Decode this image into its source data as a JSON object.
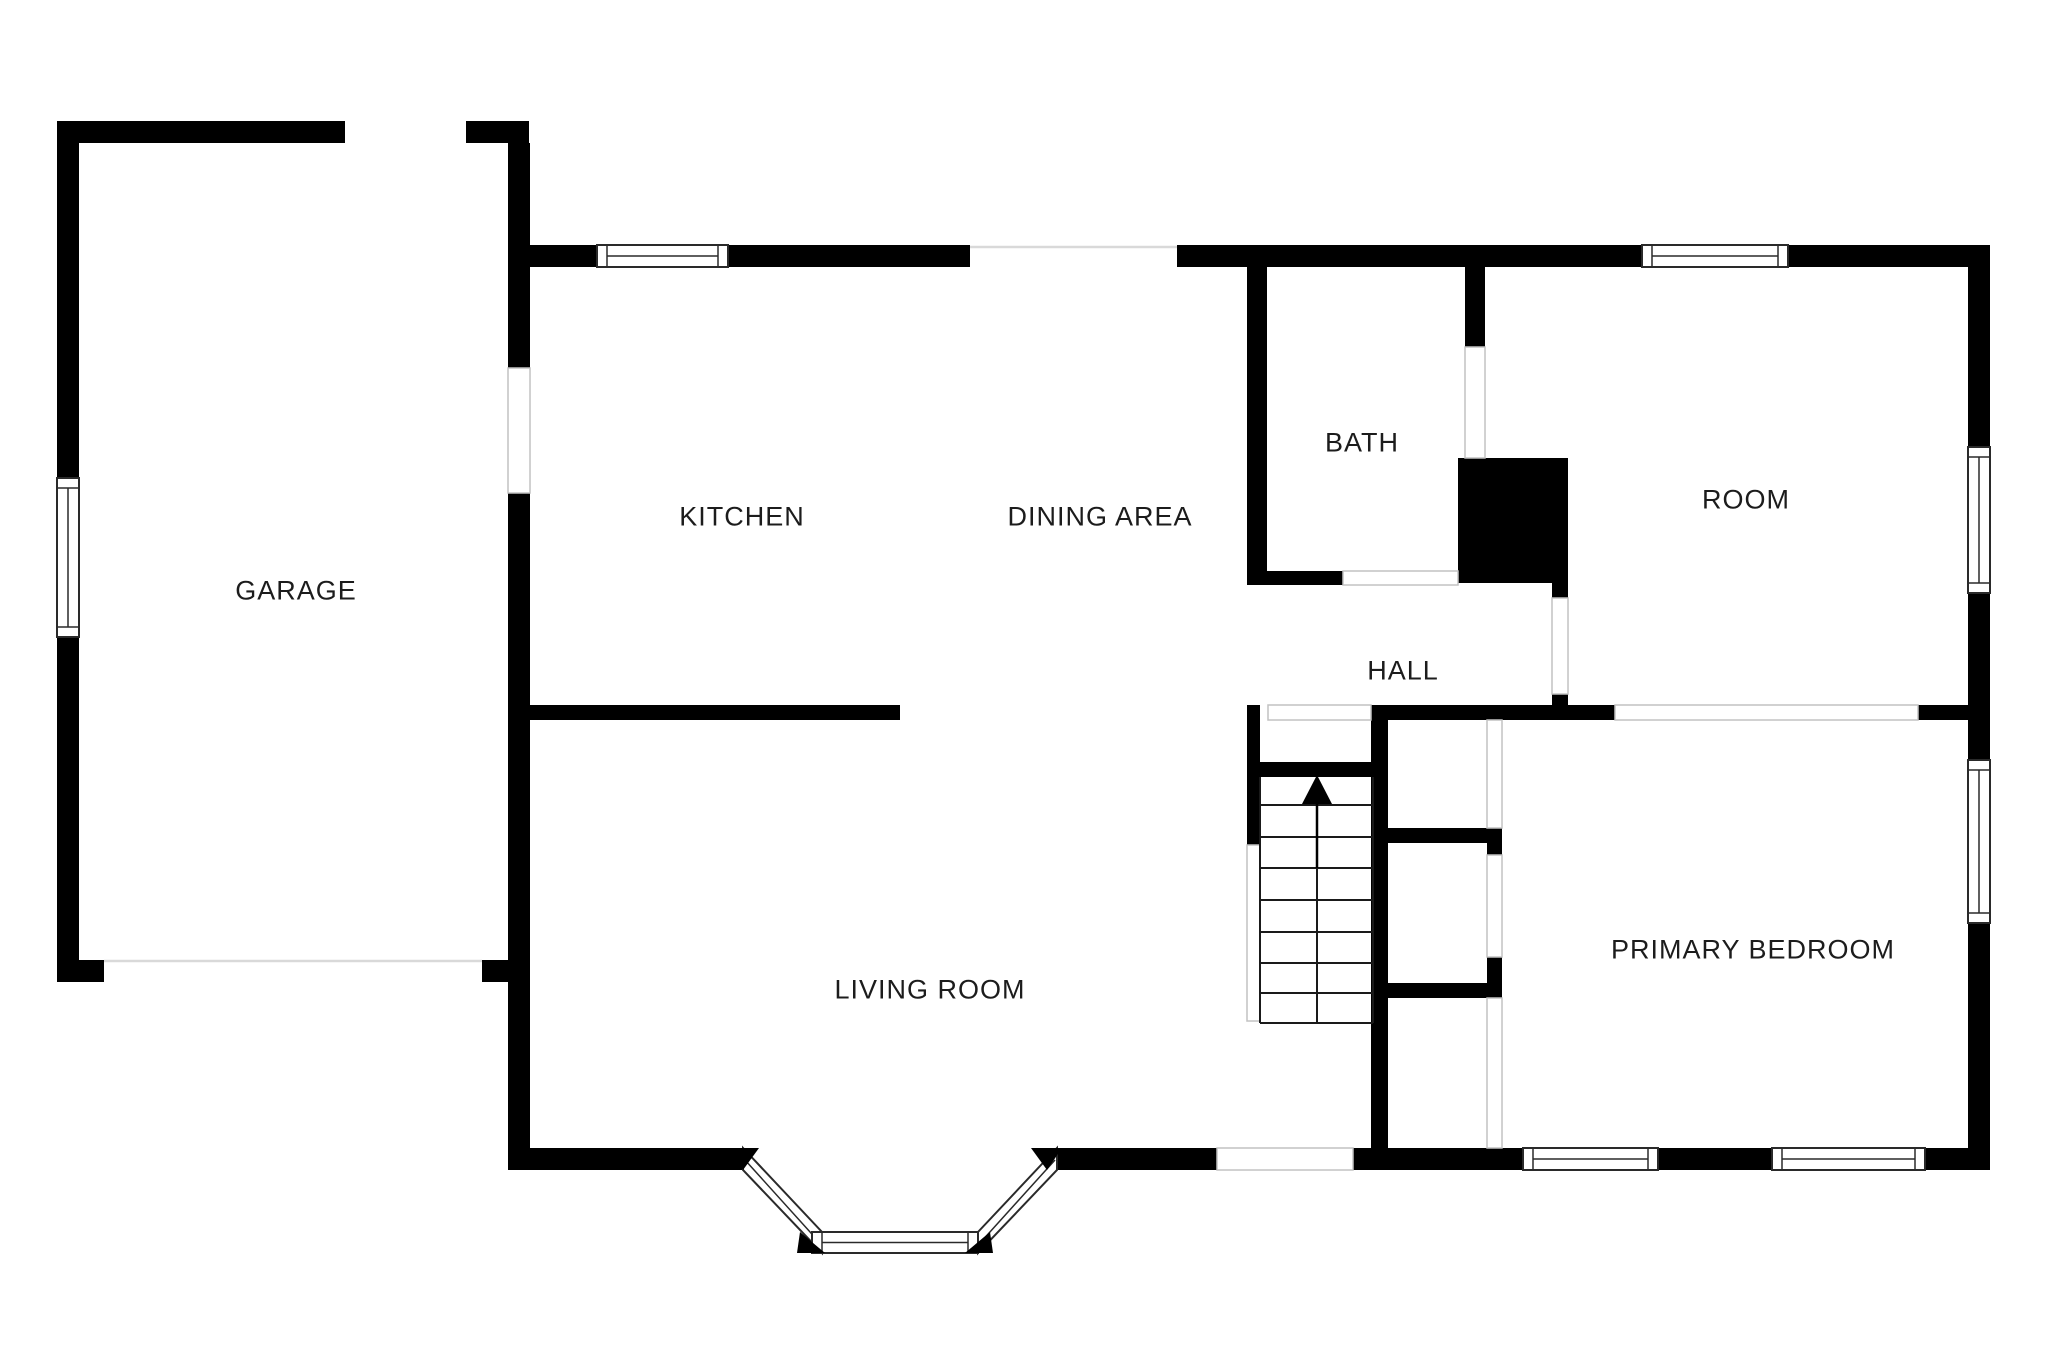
{
  "meta": {
    "title": "Floor plan",
    "canvas_width": 2048,
    "canvas_height": 1365
  },
  "colors": {
    "background": "#ffffff",
    "wall": "#000000",
    "window_frame": "#2a2a2a",
    "opening_outline": "#c2c2c2",
    "faint_line": "#d9d9d9",
    "stair_line": "#1a1a1a",
    "label": "#1c1c1c"
  },
  "rooms": [
    {
      "id": "garage",
      "label": "GARAGE",
      "style": "left:296px;top:591px"
    },
    {
      "id": "kitchen",
      "label": "KITCHEN",
      "style": "left:742px;top:517px"
    },
    {
      "id": "dining-area",
      "label": "DINING AREA",
      "style": "left:1100px;top:517px"
    },
    {
      "id": "bath",
      "label": "BATH",
      "style": "left:1362px;top:443px"
    },
    {
      "id": "room",
      "label": "ROOM",
      "style": "left:1746px;top:500px"
    },
    {
      "id": "hall",
      "label": "HALL",
      "style": "left:1403px;top:671px"
    },
    {
      "id": "living-room",
      "label": "LIVING ROOM",
      "style": "left:930px;top:990px"
    },
    {
      "id": "primary-bedroom",
      "label": "PRIMARY BEDROOM",
      "style": "left:1753px;top:950px"
    }
  ],
  "plan": {
    "walls": [
      {
        "name": "garage-top-wall",
        "x": 57,
        "y": 121,
        "w": 288,
        "h": 22
      },
      {
        "name": "entry-nub-wall",
        "x": 466,
        "y": 121,
        "w": 63,
        "h": 22
      },
      {
        "name": "garage-left-wall-upper",
        "x": 57,
        "y": 121,
        "w": 22,
        "h": 357
      },
      {
        "name": "garage-left-wall-lower",
        "x": 57,
        "y": 637,
        "w": 22,
        "h": 345
      },
      {
        "name": "garage-bottom-wall-left",
        "x": 57,
        "y": 960,
        "w": 47,
        "h": 22
      },
      {
        "name": "garage-bottom-wall-right",
        "x": 482,
        "y": 960,
        "w": 26,
        "h": 22
      },
      {
        "name": "west-shared-wall-upper",
        "x": 508,
        "y": 143,
        "w": 22,
        "h": 225
      },
      {
        "name": "west-shared-wall-lower",
        "x": 508,
        "y": 493,
        "w": 22,
        "h": 677
      },
      {
        "name": "kitchen-top-wall",
        "x": 530,
        "y": 245,
        "w": 440,
        "h": 22
      },
      {
        "name": "bath-room-top-wall",
        "x": 1177,
        "y": 245,
        "w": 813,
        "h": 22
      },
      {
        "name": "right-exterior-wall",
        "x": 1968,
        "y": 245,
        "w": 22,
        "h": 925
      },
      {
        "name": "bath-left-wall",
        "x": 1247,
        "y": 267,
        "w": 20,
        "h": 318
      },
      {
        "name": "bath-bottom-wall",
        "x": 1247,
        "y": 571,
        "w": 96,
        "h": 14
      },
      {
        "name": "bath-right-wall",
        "x": 1465,
        "y": 267,
        "w": 20,
        "h": 80
      },
      {
        "name": "chimney-block",
        "x": 1458,
        "y": 458,
        "w": 110,
        "h": 125
      },
      {
        "name": "chimney-step",
        "x": 1552,
        "y": 583,
        "w": 16,
        "h": 15
      },
      {
        "name": "hall-door-stub",
        "x": 1552,
        "y": 694,
        "w": 16,
        "h": 12
      },
      {
        "name": "kitchen-living-divider",
        "x": 530,
        "y": 705,
        "w": 370,
        "h": 15
      },
      {
        "name": "stairs-left-wall",
        "x": 1247,
        "y": 705,
        "w": 13,
        "h": 140
      },
      {
        "name": "hall-bottom-wall",
        "x": 1371,
        "y": 705,
        "w": 244,
        "h": 15
      },
      {
        "name": "bedroom-top-wall-east",
        "x": 1918,
        "y": 705,
        "w": 50,
        "h": 15
      },
      {
        "name": "stairs-right-wall",
        "x": 1371,
        "y": 705,
        "w": 17,
        "h": 465
      },
      {
        "name": "stairs-landing-wall",
        "x": 1260,
        "y": 762,
        "w": 113,
        "h": 15
      },
      {
        "name": "closet-wall-upper",
        "x": 1388,
        "y": 828,
        "w": 114,
        "h": 15
      },
      {
        "name": "closet-post-upper",
        "x": 1487,
        "y": 843,
        "w": 15,
        "h": 12
      },
      {
        "name": "closet-post-lower",
        "x": 1487,
        "y": 957,
        "w": 15,
        "h": 26
      },
      {
        "name": "closet-wall-lower",
        "x": 1388,
        "y": 983,
        "w": 114,
        "h": 15
      },
      {
        "name": "living-bottom-wall-west",
        "x": 508,
        "y": 1148,
        "w": 235,
        "h": 22
      },
      {
        "name": "living-bottom-wall-east",
        "x": 1057,
        "y": 1148,
        "w": 160,
        "h": 22
      },
      {
        "name": "bedroom-bottom-wall-1",
        "x": 1353,
        "y": 1148,
        "w": 170,
        "h": 22
      },
      {
        "name": "bedroom-bottom-wall-2",
        "x": 1658,
        "y": 1148,
        "w": 114,
        "h": 22
      },
      {
        "name": "bedroom-bottom-wall-3",
        "x": 1925,
        "y": 1148,
        "w": 65,
        "h": 22
      }
    ],
    "windows": [
      {
        "name": "garage-left-window",
        "x": 57,
        "y": 478,
        "w": 22,
        "h": 159,
        "orient": "v"
      },
      {
        "name": "kitchen-top-window",
        "x": 597,
        "y": 245,
        "w": 131,
        "h": 22,
        "orient": "h"
      },
      {
        "name": "room-top-window",
        "x": 1642,
        "y": 245,
        "w": 146,
        "h": 22,
        "orient": "h"
      },
      {
        "name": "room-right-window",
        "x": 1968,
        "y": 447,
        "w": 22,
        "h": 146,
        "orient": "v"
      },
      {
        "name": "bedroom-right-window",
        "x": 1968,
        "y": 760,
        "w": 22,
        "h": 163,
        "orient": "v"
      },
      {
        "name": "bedroom-bottom-window-1",
        "x": 1523,
        "y": 1148,
        "w": 135,
        "h": 22,
        "orient": "h"
      },
      {
        "name": "bedroom-bottom-window-2",
        "x": 1772,
        "y": 1148,
        "w": 153,
        "h": 22,
        "orient": "h"
      }
    ],
    "openings": [
      {
        "name": "garage-kitchen-door",
        "x": 508,
        "y": 368,
        "w": 22,
        "h": 125
      },
      {
        "name": "bath-bottom-door",
        "x": 1343,
        "y": 571,
        "w": 115,
        "h": 14
      },
      {
        "name": "bath-right-door",
        "x": 1465,
        "y": 347,
        "w": 20,
        "h": 111
      },
      {
        "name": "hall-room-door",
        "x": 1552,
        "y": 598,
        "w": 16,
        "h": 96
      },
      {
        "name": "stairs-top-opening",
        "x": 1268,
        "y": 705,
        "w": 103,
        "h": 15
      },
      {
        "name": "bedroom-wide-opening",
        "x": 1615,
        "y": 705,
        "w": 303,
        "h": 15
      },
      {
        "name": "closet-door-1",
        "x": 1487,
        "y": 720,
        "w": 15,
        "h": 108
      },
      {
        "name": "closet-door-2",
        "x": 1487,
        "y": 855,
        "w": 15,
        "h": 102
      },
      {
        "name": "closet-door-3",
        "x": 1487,
        "y": 998,
        "w": 15,
        "h": 150
      },
      {
        "name": "back-door",
        "x": 1217,
        "y": 1148,
        "w": 136,
        "h": 22
      },
      {
        "name": "understair-strip",
        "x": 1247,
        "y": 845,
        "w": 13,
        "h": 176
      }
    ],
    "faint_lines": [
      {
        "name": "garage-door-line",
        "x1": 104,
        "y1": 961,
        "x2": 482,
        "y2": 961
      },
      {
        "name": "dining-open-line",
        "x1": 970,
        "y1": 247,
        "x2": 1177,
        "y2": 247
      }
    ],
    "stairs": {
      "name": "staircase",
      "tread_x1": 1260,
      "tread_x2": 1373,
      "tread_ys": [
        805,
        837,
        868,
        900,
        932,
        963,
        993,
        1023
      ],
      "side_xs": [
        1260,
        1373
      ],
      "side_y1": 777,
      "side_y2": 1023,
      "center_x": 1317,
      "center_y1": 803,
      "center_y2": 1023,
      "arrow_points": "1317,775 1302,804 1332,804",
      "stem_y1": 804,
      "stem_y2": 868
    },
    "bay_window": {
      "left_band": {
        "points": "743,1148 822,1232 822,1253 743,1170",
        "center": [
          745,
          1160,
          820,
          1243
        ]
      },
      "right_band": {
        "points": "978,1232 1057,1148 1057,1170 978,1253",
        "center": [
          980,
          1243,
          1055,
          1160
        ]
      },
      "bottom_window": {
        "x": 812,
        "y": 1232,
        "w": 166,
        "h": 21
      },
      "wedges": [
        "728,1148 759,1148 743,1170",
        "800,1232 825,1253 797,1253",
        "990,1232 965,1253 993,1253",
        "1031,1148 1062,1148 1047,1170"
      ]
    }
  }
}
